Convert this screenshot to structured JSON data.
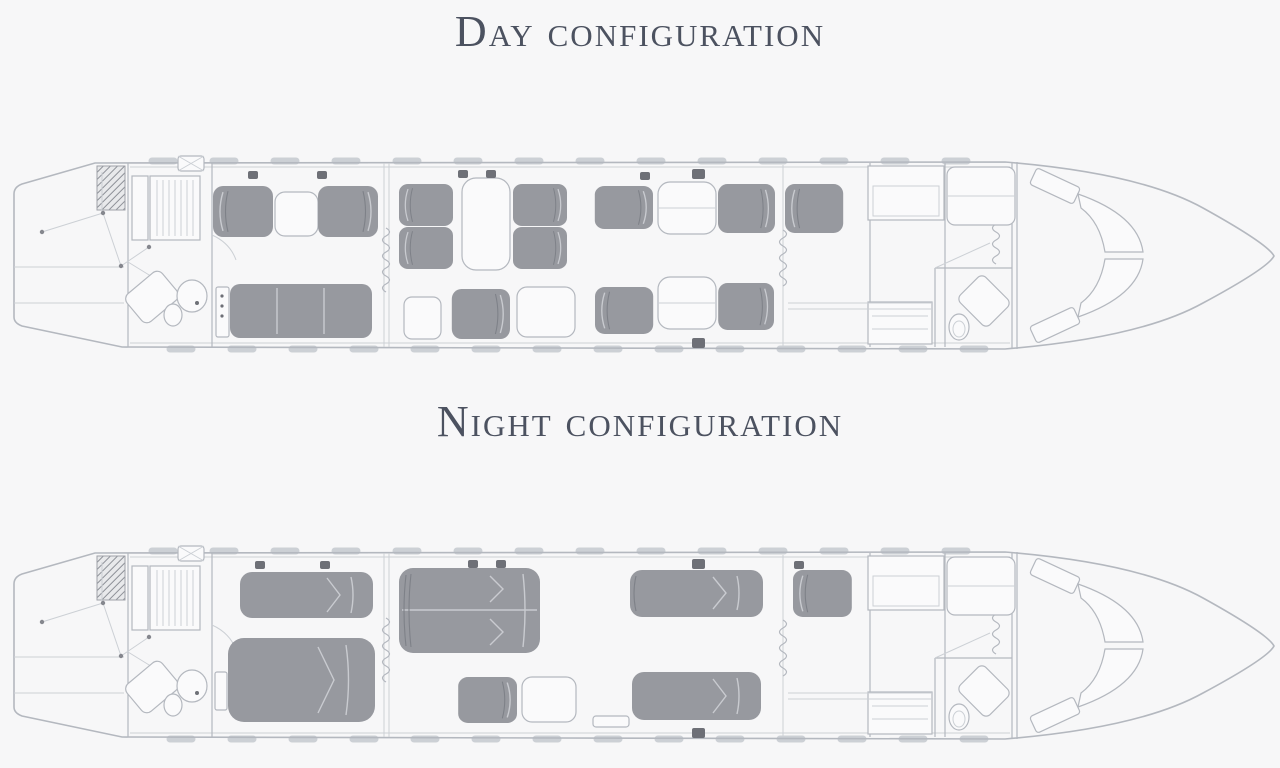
{
  "titles": {
    "day": "Day configuration",
    "night": "Night configuration"
  },
  "palette": {
    "bg": "#f7f7f8",
    "seat": "#97999f",
    "line1": "#b4b8bf",
    "line2": "#ccd0d5",
    "white": "#fafafb",
    "seamlight": "#c9cbd0",
    "seamdark": "#7e8188",
    "dots": "#6e7077",
    "title": "#4c5260"
  }
}
